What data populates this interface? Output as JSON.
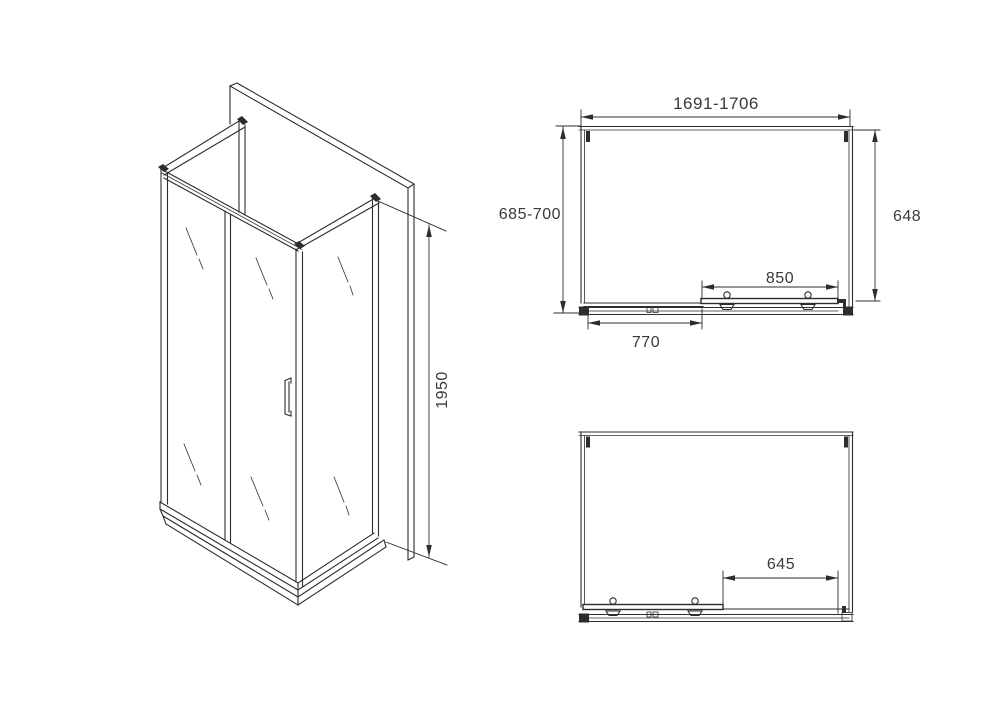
{
  "drawing": {
    "type": "shower-enclosure-technical-drawing",
    "colors": {
      "line": "#2d2d2d",
      "text": "#3a3a3a",
      "background": "#ffffff"
    },
    "dimensions": {
      "iso_height": "1950",
      "plan_width": "1691-1706",
      "plan_left_depth": "685-700",
      "plan_right_depth": "648",
      "door_width": "850",
      "fixed_panel_width": "770",
      "open_passage_width": "645"
    }
  }
}
